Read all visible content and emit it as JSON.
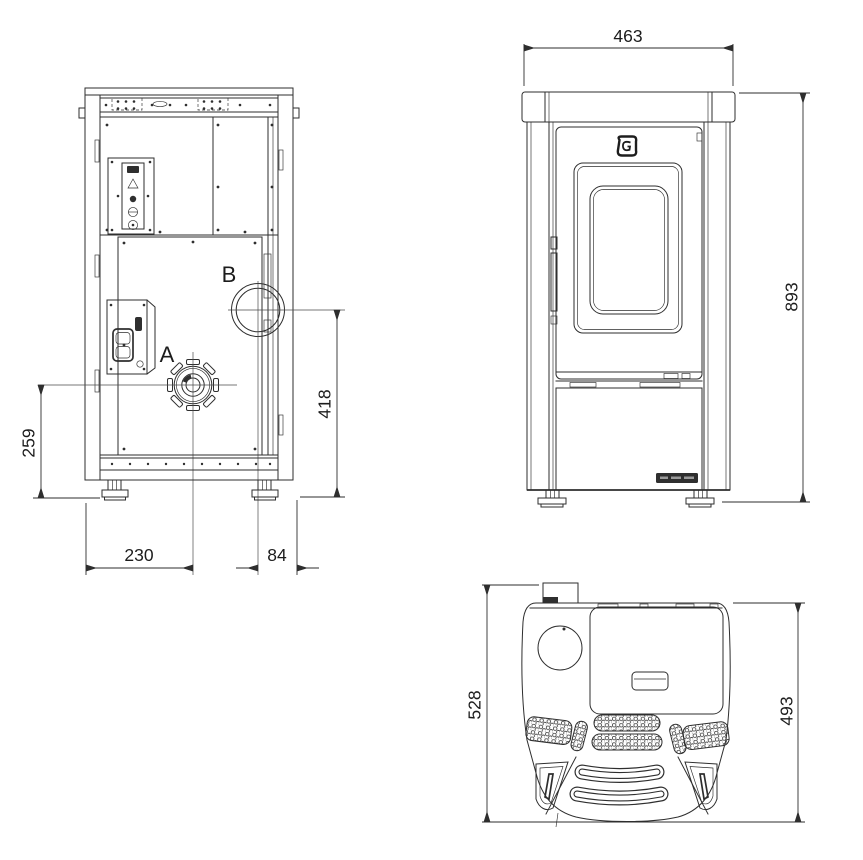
{
  "page": {
    "background": "#ffffff",
    "line_color": "#2e2e2e"
  },
  "views": {
    "rear": {
      "labels": {
        "air_intake_port": "A",
        "flue_outlet_port": "B"
      },
      "dimensions": {
        "height_to_air_intake": "259",
        "height_to_flue_outlet": "418",
        "offset_air_intake": "230",
        "offset_flue_outlet": "84"
      }
    },
    "front": {
      "dimensions": {
        "width": "463",
        "height": "893"
      }
    },
    "top": {
      "dimensions": {
        "depth_overall": "528",
        "depth_body": "493"
      }
    }
  },
  "icons": {
    "brand_logo": "manufacturer-emblem",
    "brand_plate": "manufacturer-nameplate"
  }
}
